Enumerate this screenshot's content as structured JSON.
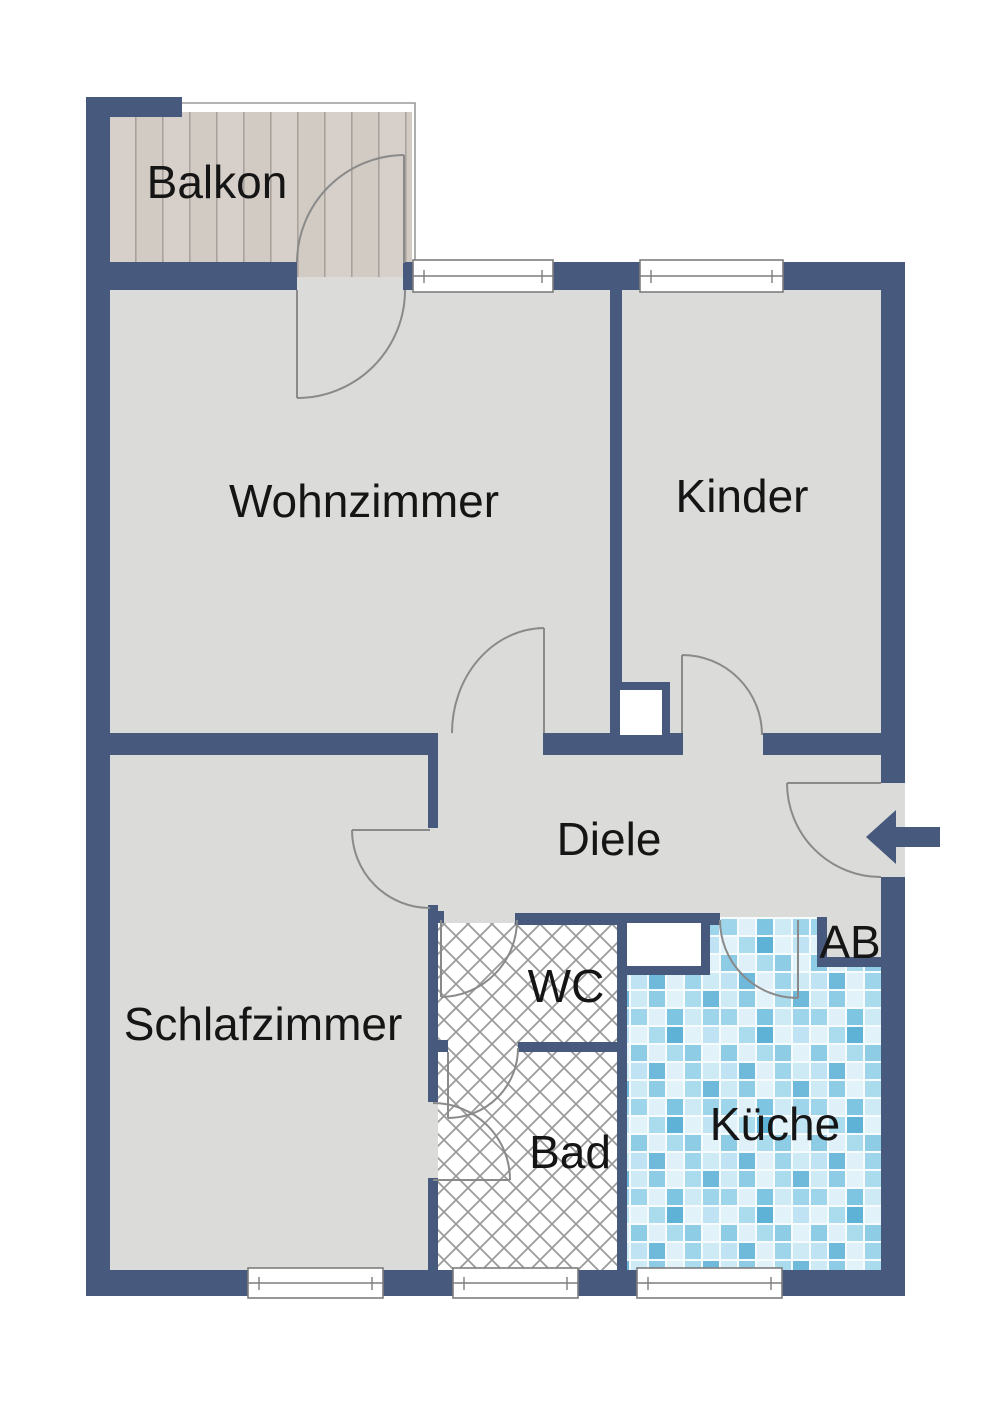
{
  "rooms": {
    "balkon": {
      "label": "Balkon"
    },
    "wohnzimmer": {
      "label": "Wohnzimmer"
    },
    "kinder": {
      "label": "Kinder"
    },
    "diele": {
      "label": "Diele"
    },
    "schlafzimmer": {
      "label": "Schlafzimmer"
    },
    "wc": {
      "label": "WC"
    },
    "bad": {
      "label": "Bad"
    },
    "kueche": {
      "label": "Küche"
    },
    "ab": {
      "label": "AB"
    }
  },
  "icons": {
    "entrance_arrow": "arrow-pointing-left-into-entrance-door"
  },
  "colors": {
    "wall": "#47597c",
    "floor": "#dbdbd9",
    "door_arc": "#8a8a8a",
    "label_text": "#151515",
    "balcony_wood": "#d6cfc8",
    "hatch_line": "#9b9b9b",
    "tile_blues": [
      "#e2f2f9",
      "#cdeaf5",
      "#9ed5ea",
      "#7ec5e2",
      "#5eb2d6"
    ]
  }
}
